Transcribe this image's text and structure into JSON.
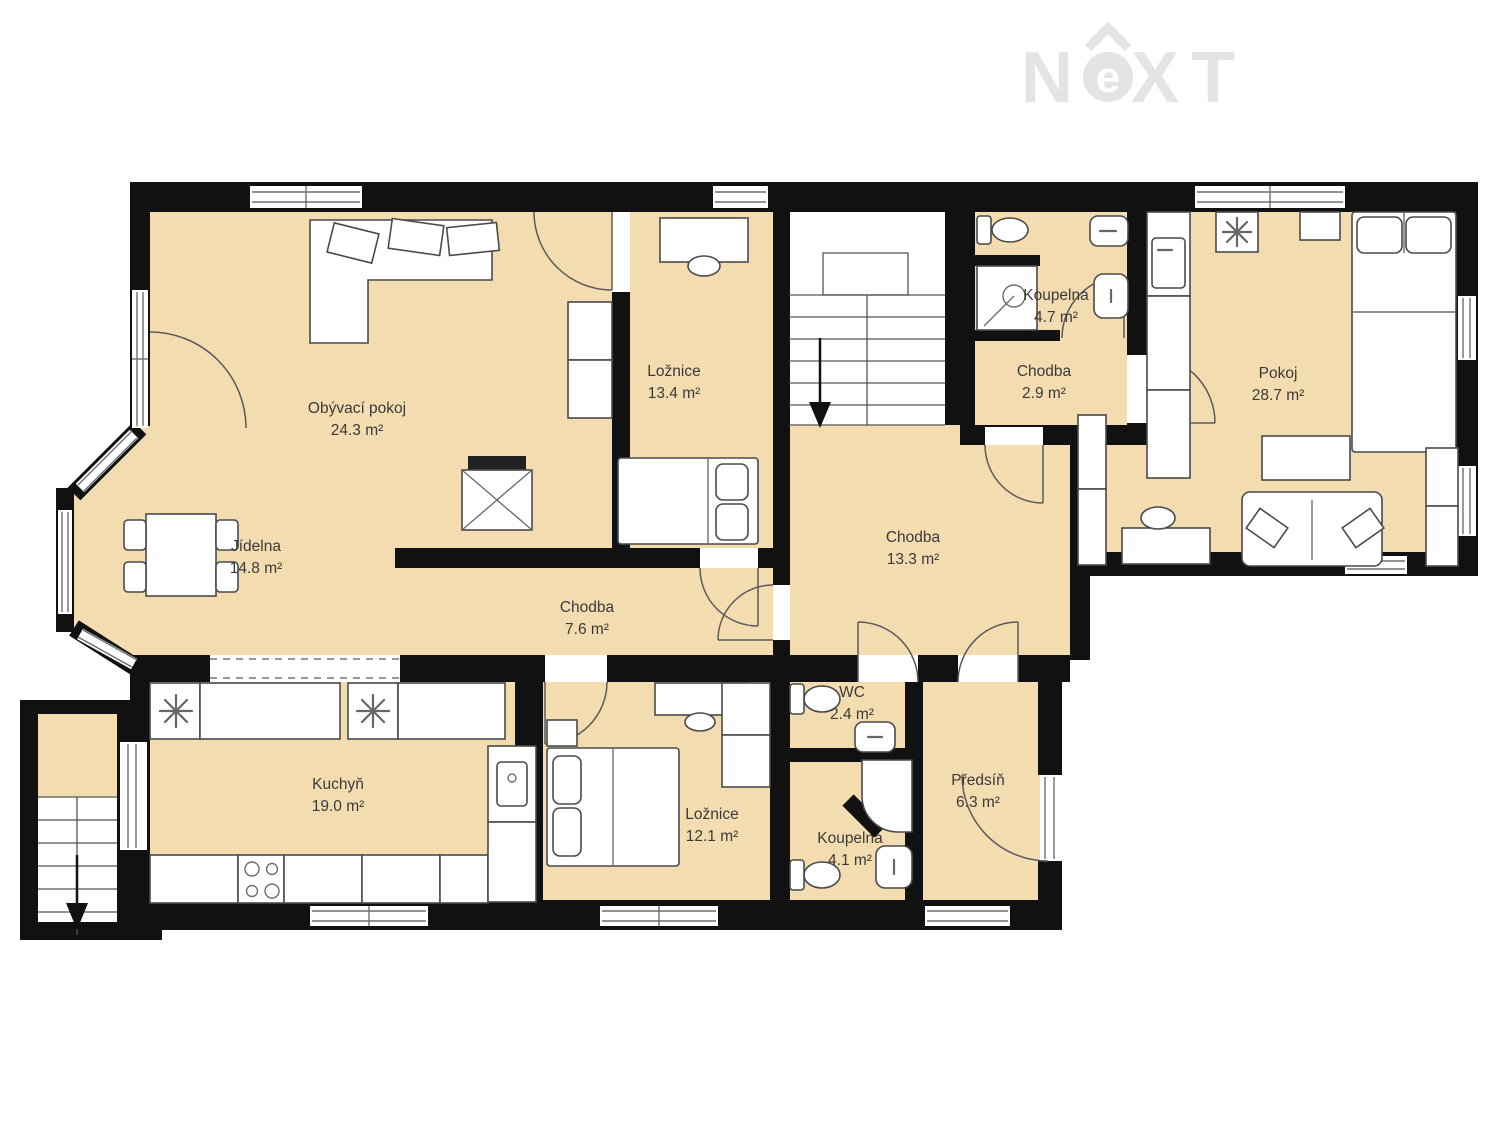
{
  "page": {
    "background": "#ffffff"
  },
  "logo": {
    "name": "NeXT",
    "letters": {
      "n": "N",
      "e": "e",
      "x": "X",
      "t": "T"
    },
    "color": "#e4e4e4"
  },
  "plan": {
    "floor_color": "#f3dcb0",
    "wall_color": "#111111",
    "label_color": "#3a3a3a",
    "rooms": [
      {
        "name": "Obývací pokoj",
        "area": "24.3 m²"
      },
      {
        "name": "Ložnice",
        "area": "13.4 m²"
      },
      {
        "name": "Koupelna",
        "area": "4.7 m²"
      },
      {
        "name": "Chodba",
        "area": "2.9 m²"
      },
      {
        "name": "Pokoj",
        "area": "28.7 m²"
      },
      {
        "name": "Jídelna",
        "area": "14.8 m²"
      },
      {
        "name": "Chodba",
        "area": "13.3 m²"
      },
      {
        "name": "Chodba",
        "area": "7.6 m²"
      },
      {
        "name": "Kuchyň",
        "area": "19.0 m²"
      },
      {
        "name": "Ložnice",
        "area": "12.1 m²"
      },
      {
        "name": "WC",
        "area": "2.4 m²"
      },
      {
        "name": "Koupelna",
        "area": "4.1 m²"
      },
      {
        "name": "Předsíň",
        "area": "6.3 m²"
      }
    ]
  }
}
